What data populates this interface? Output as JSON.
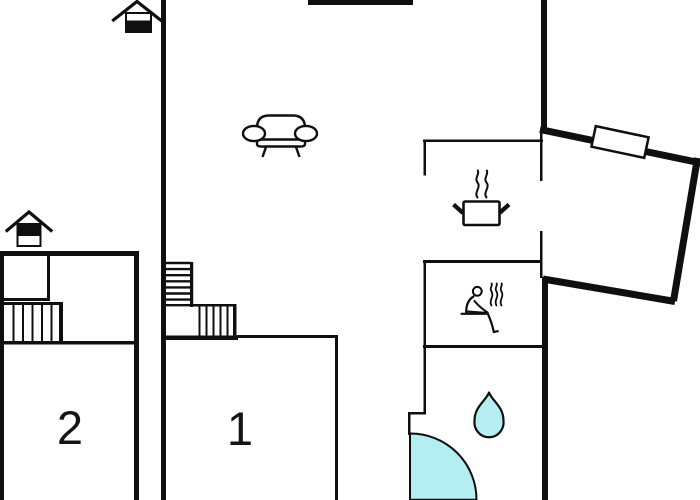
{
  "plan": {
    "type": "floor-plan",
    "rooms": {
      "room1": {
        "label": "1"
      },
      "room2": {
        "label": "2"
      }
    },
    "icons": {
      "floor_indicator_top": "house-lower-level-filled-icon",
      "floor_indicator_left": "house-upper-level-filled-icon",
      "living": "sofa-icon",
      "kitchen": "cooking-pot-icon",
      "sauna": "sauna-person-icon",
      "bathroom": "water-drop-icon",
      "entry": "door-swing-arc",
      "window": "window-on-angled-wall"
    },
    "colors": {
      "wall": "#0f0f0f",
      "water": "#b4edf2",
      "background": "#ffffff"
    }
  }
}
